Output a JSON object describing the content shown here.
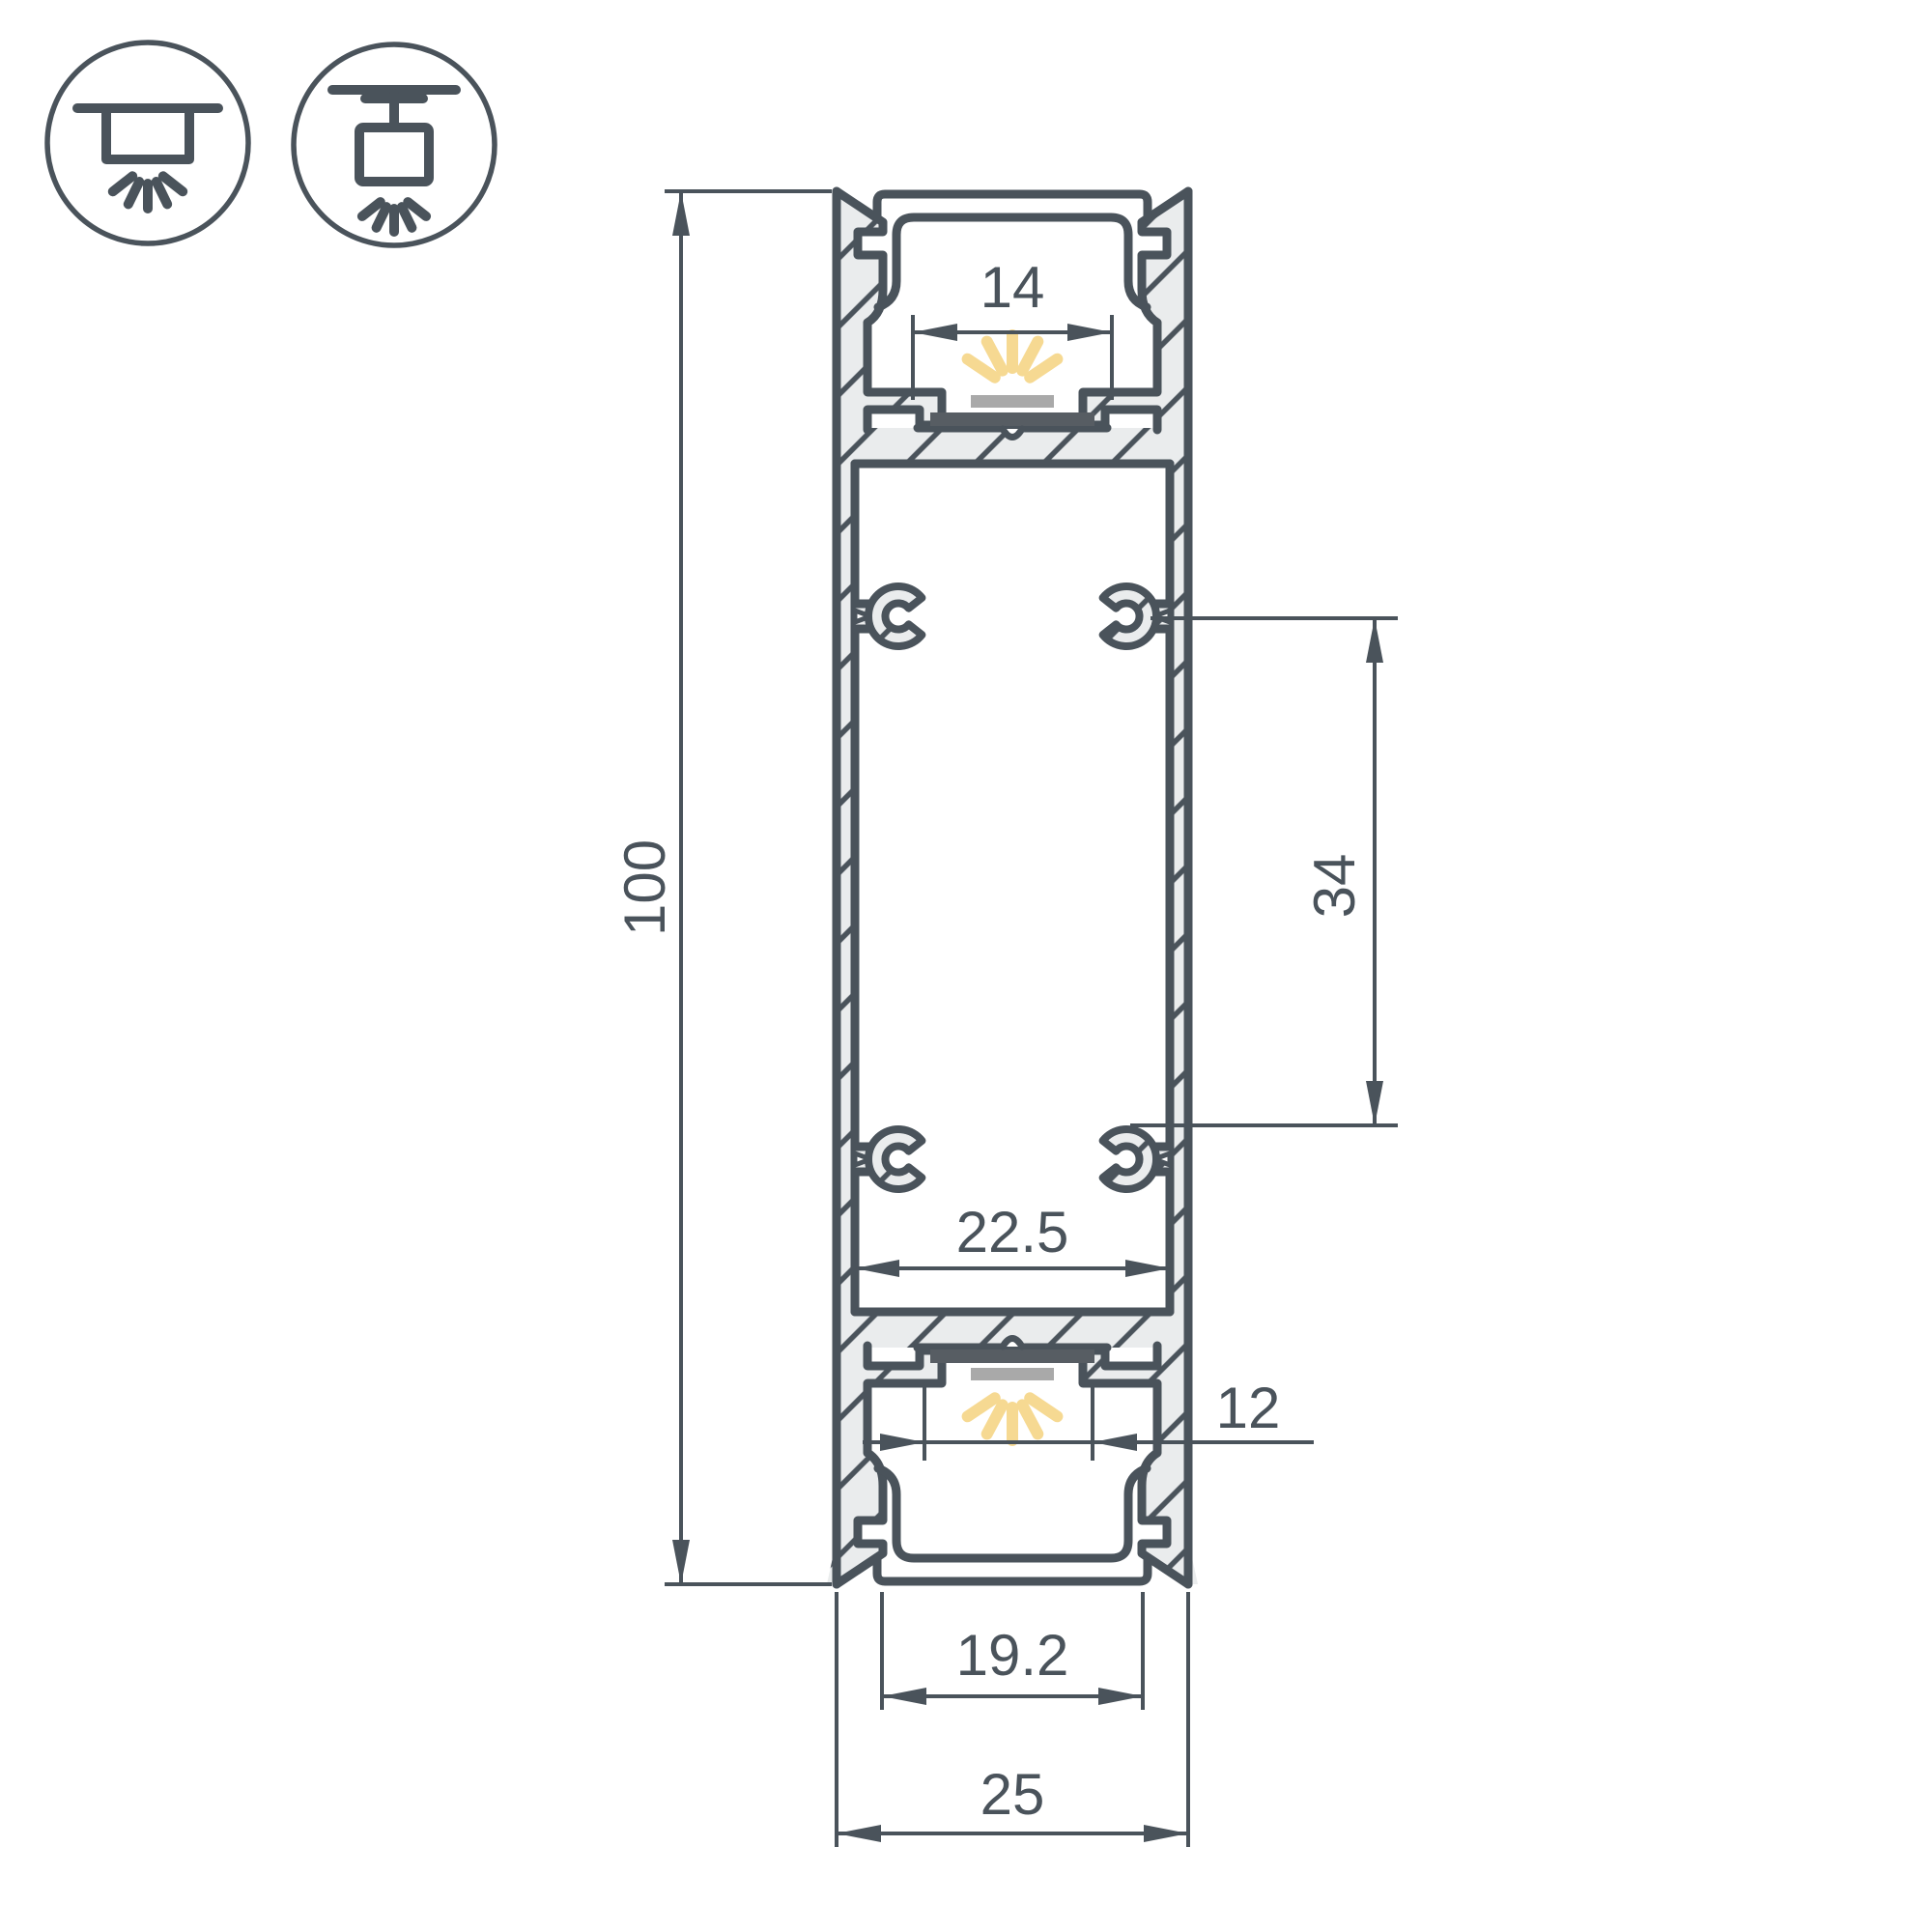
{
  "legend": {
    "recessed_icon": "recessed-ceiling-mount-icon",
    "suspended_icon": "suspended-pendant-mount-icon"
  },
  "profile": {
    "description": "aluminium-led-profile-cross-section",
    "dims": {
      "overall_height": "100",
      "top_window": "14",
      "boss_spacing": "34",
      "inner_width": "22.5",
      "bottom_window": "12",
      "bottom_opening": "19.2",
      "overall_width": "25"
    },
    "colors": {
      "line": "#4a535b",
      "metal": "#eaeced",
      "glow": "#f6d992",
      "led": "#a9a9a9",
      "pcb": "#575d63",
      "background": "#ffffff"
    }
  }
}
